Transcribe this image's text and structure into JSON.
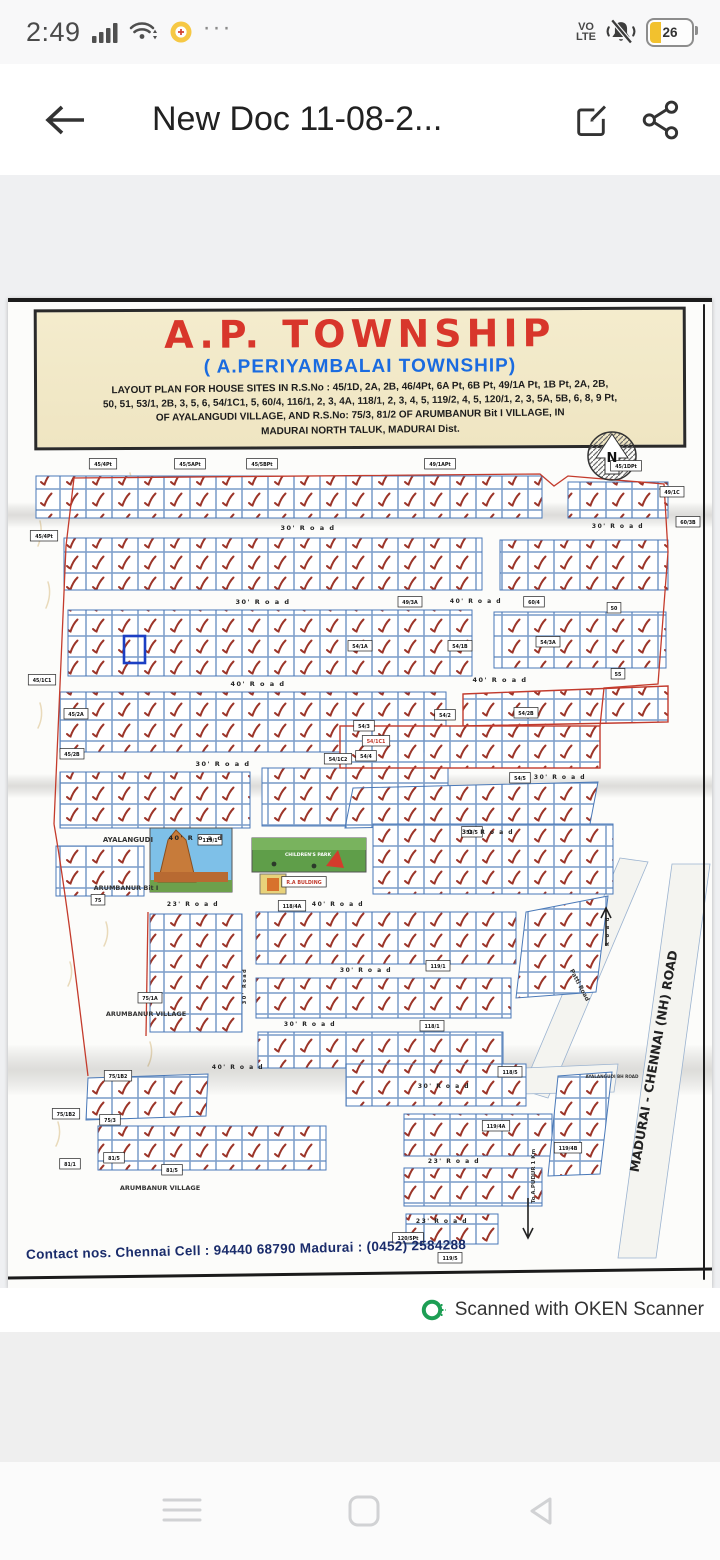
{
  "status_bar": {
    "time": "2:49",
    "more_dots": "···",
    "volte_line1": "VO",
    "volte_line2": "LTE",
    "battery_percent": "26"
  },
  "app_bar": {
    "title": "New Doc 11-08-2..."
  },
  "doc": {
    "title": "A.P. TOWNSHIP",
    "subtitle": "( A.PERIYAMBALAI  TOWNSHIP)",
    "desc_lines": {
      "l1": "LAYOUT PLAN FOR HOUSE SITES IN R.S.No : 45/1D, 2A, 2B,  46/4Pt, 6A Pt, 6B Pt, 49/1A Pt, 1B Pt, 2A, 2B,",
      "l2": "50, 51, 53/1, 2B, 3, 5, 6, 54/1C1, 5, 60/4, 116/1, 2, 3, 4A, 118/1, 2, 3, 4, 5, 119/2, 4, 5, 120/1, 2, 3, 5A, 5B, 6, 8, 9 Pt,",
      "l3": "OF AYALANGUDI VILLAGE, AND R.S.No: 75/3, 81/2 OF ARUMBANUR Bit I  VILLAGE, IN",
      "l4": "MADURAI NORTH TALUK, MADURAI Dist."
    },
    "contact": "Contact nos. Chennai Cell : 94440 68790   Madurai : (0452) 2584288"
  },
  "map": {
    "colors": {
      "plot_line": "#4a79b8",
      "check": "#9c3529",
      "boundary": "#c43b2c",
      "highlight": "#1b3fc4"
    },
    "road_labels": [
      {
        "t": "30'  R o a d",
        "x": 300,
        "y": 104,
        "s": 6.5
      },
      {
        "t": "30'  R o a d",
        "x": 610,
        "y": 102,
        "s": 6
      },
      {
        "t": "30'  R o a d",
        "x": 255,
        "y": 178,
        "s": 6.5
      },
      {
        "t": "40'  R o a d",
        "x": 250,
        "y": 260,
        "s": 6.5
      },
      {
        "t": "40'  R o a d",
        "x": 468,
        "y": 177,
        "s": 6
      },
      {
        "t": "40'  R o a d",
        "x": 492,
        "y": 256,
        "s": 6.5
      },
      {
        "t": "30'  R o a d",
        "x": 215,
        "y": 340,
        "s": 6.5
      },
      {
        "t": "30'  R o a d",
        "x": 552,
        "y": 353,
        "s": 6
      },
      {
        "t": "40'  R o a d",
        "x": 188,
        "y": 414,
        "s": 6.5
      },
      {
        "t": "30'  R o a d",
        "x": 480,
        "y": 408,
        "s": 6
      },
      {
        "t": "23'  R o a d",
        "x": 185,
        "y": 480,
        "s": 6
      },
      {
        "t": "40'  R o a d",
        "x": 330,
        "y": 480,
        "s": 6
      },
      {
        "t": "30'  R o a d",
        "x": 358,
        "y": 546,
        "s": 6
      },
      {
        "t": "30'  R o a d",
        "x": 302,
        "y": 600,
        "s": 6
      },
      {
        "t": "40'  R o a d",
        "x": 230,
        "y": 643,
        "s": 6
      },
      {
        "t": "30'  R o a d",
        "x": 436,
        "y": 662,
        "s": 6
      },
      {
        "t": "23'  R o a d",
        "x": 446,
        "y": 737,
        "s": 6
      },
      {
        "t": "23'  R o a d",
        "x": 434,
        "y": 797,
        "s": 6
      },
      {
        "t": "30' Road",
        "x": 238,
        "y": 560,
        "s": 5,
        "r": -90
      },
      {
        "t": "R o a d",
        "x": 601,
        "y": 505,
        "s": 5,
        "r": -90
      }
    ],
    "survey_boxes": [
      {
        "t": "45/4Pt",
        "x": 95,
        "y": 38
      },
      {
        "t": "45/5APt",
        "x": 182,
        "y": 38
      },
      {
        "t": "45/5BPt",
        "x": 254,
        "y": 38
      },
      {
        "t": "49/1APt",
        "x": 432,
        "y": 38
      },
      {
        "t": "45/1DPt",
        "x": 618,
        "y": 40
      },
      {
        "t": "49/1C",
        "x": 664,
        "y": 66
      },
      {
        "t": "60/3B",
        "x": 680,
        "y": 96
      },
      {
        "t": "45/4Pt",
        "x": 36,
        "y": 110
      },
      {
        "t": "45/1C1",
        "x": 34,
        "y": 254
      },
      {
        "t": "45/2A",
        "x": 68,
        "y": 288
      },
      {
        "t": "45/2B",
        "x": 64,
        "y": 328
      },
      {
        "t": "49/3A",
        "x": 402,
        "y": 176
      },
      {
        "t": "60/4",
        "x": 526,
        "y": 176
      },
      {
        "t": "50",
        "x": 606,
        "y": 182
      },
      {
        "t": "55",
        "x": 610,
        "y": 248
      },
      {
        "t": "54/1A",
        "x": 352,
        "y": 220
      },
      {
        "t": "54/1B",
        "x": 452,
        "y": 220
      },
      {
        "t": "54/3A",
        "x": 540,
        "y": 216
      },
      {
        "t": "54/2",
        "x": 437,
        "y": 289
      },
      {
        "t": "54/2B",
        "x": 518,
        "y": 287
      },
      {
        "t": "54/3",
        "x": 356,
        "y": 300
      },
      {
        "t": "54/4",
        "x": 358,
        "y": 330
      },
      {
        "t": "54/1C1",
        "x": 368,
        "y": 315,
        "red": true
      },
      {
        "t": "54/1C2",
        "x": 330,
        "y": 333
      },
      {
        "t": "54/5",
        "x": 512,
        "y": 352
      },
      {
        "t": "53/5",
        "x": 464,
        "y": 406
      },
      {
        "t": "119/1",
        "x": 202,
        "y": 414
      },
      {
        "t": "75",
        "x": 90,
        "y": 474
      },
      {
        "t": "75/1A",
        "x": 142,
        "y": 572
      },
      {
        "t": "118/4A",
        "x": 284,
        "y": 480
      },
      {
        "t": "119/1",
        "x": 430,
        "y": 540
      },
      {
        "t": "118/1",
        "x": 424,
        "y": 600
      },
      {
        "t": "118/5",
        "x": 502,
        "y": 646
      },
      {
        "t": "R.A BULDING",
        "x": 296,
        "y": 456,
        "red": true
      },
      {
        "t": "75/1B2",
        "x": 110,
        "y": 650
      },
      {
        "t": "75/1B2",
        "x": 58,
        "y": 688
      },
      {
        "t": "75/3",
        "x": 102,
        "y": 694
      },
      {
        "t": "81/1",
        "x": 62,
        "y": 738
      },
      {
        "t": "81/5",
        "x": 106,
        "y": 732
      },
      {
        "t": "81/5",
        "x": 164,
        "y": 744
      },
      {
        "t": "119/4A",
        "x": 488,
        "y": 700
      },
      {
        "t": "119/4B",
        "x": 560,
        "y": 722
      },
      {
        "t": "120/5Pt",
        "x": 400,
        "y": 812
      },
      {
        "t": "119/5",
        "x": 442,
        "y": 832
      }
    ],
    "area_labels": [
      {
        "t": "AYALANGUDI",
        "x": 120,
        "y": 416,
        "s": 7
      },
      {
        "t": "ARUMBANUR Bit I",
        "x": 118,
        "y": 464,
        "s": 6.5
      },
      {
        "t": "ARUMBANUR VILLAGE",
        "x": 138,
        "y": 590,
        "s": 6.5
      },
      {
        "t": "ARUMBANUR VILLAGE",
        "x": 152,
        "y": 764,
        "s": 6.5
      },
      {
        "t": "AYALANGUDI BH ROAD",
        "x": 604,
        "y": 652,
        "s": 4.2
      },
      {
        "t": "To A.PUDUR 1 Km",
        "x": 527,
        "y": 750,
        "s": 5.5,
        "r": -90
      },
      {
        "t": "Patti Road",
        "x": 570,
        "y": 560,
        "s": 6,
        "r": 62
      },
      {
        "t": "MADURAI - CHENNAI (NH) ROAD",
        "x": 650,
        "y": 636,
        "s": 12.5,
        "r": -80,
        "c": "#222"
      },
      {
        "t": "CHILDREN'S PARK",
        "x": 300,
        "y": 430,
        "s": 4.6,
        "c": "#ffffff"
      },
      {
        "t": "N",
        "x": 604,
        "y": 36,
        "s": 13,
        "c": "#111"
      }
    ]
  },
  "footer": {
    "badge": "Scanned with OKEN Scanner"
  },
  "nav_bar": {
    "icons": [
      "menu",
      "home",
      "back"
    ]
  }
}
